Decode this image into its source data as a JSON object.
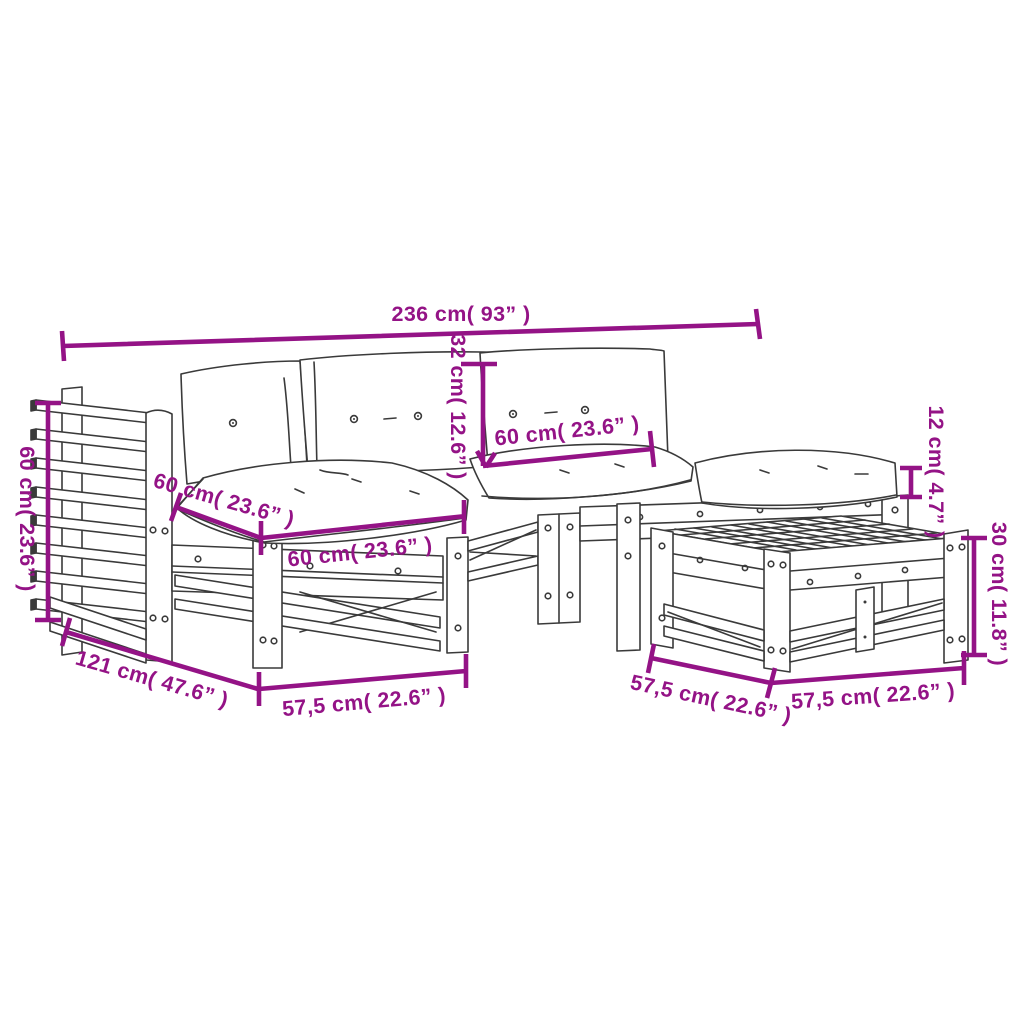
{
  "diagram": {
    "background": "#ffffff",
    "accent_color": "#941386",
    "line_color": "#3a3a3a",
    "subject": "Wooden garden lounge set line drawing: corner sofa with slatted back panel, seat and back cushions, side seat module and slatted footstool table",
    "dimensions": {
      "overall_width": "236 cm( 93” )",
      "backrest_height": "60 cm( 23.6” )",
      "back_cushion_height": "32 cm( 12.6” )",
      "back_cushion_width": "60 cm( 23.6” )",
      "seat_cushion_depth": "60 cm( 23.6” )",
      "seat_cushion_width": "60 cm( 23.6” )",
      "seat_cushion_thickness": "12 cm( 4.7” )",
      "footstool_height": "30 cm( 11.8” )",
      "overall_depth": "121 cm( 47.6” )",
      "seat_module_width": "57,5 cm( 22.6” )",
      "footstool_depth": "57,5 cm( 22.6” )",
      "footstool_width": "57,5 cm( 22.6” )"
    }
  }
}
